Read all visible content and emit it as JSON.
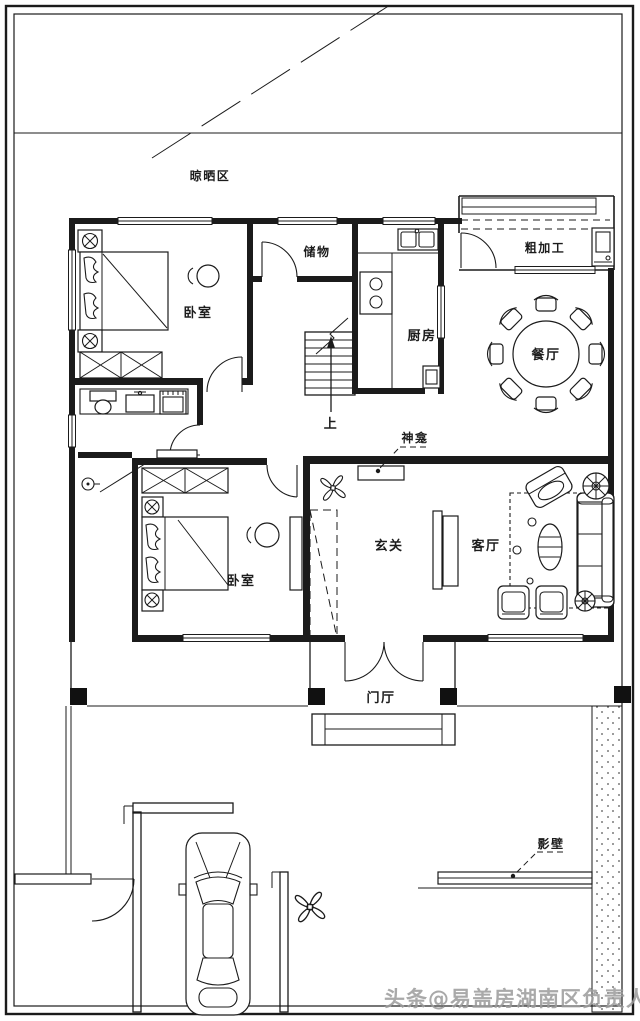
{
  "canvas": {
    "width": 640,
    "height": 1021,
    "background": "#ffffff",
    "ink": "#1b1b1b"
  },
  "labels": {
    "drying_area": "晾晒区",
    "bedroom_upper": "卧室",
    "storage": "储物",
    "kitchen": "厨房",
    "rough_processing": "粗加工",
    "dining": "餐厅",
    "shrine": "神龛",
    "entry_foyer": "玄关",
    "living": "客厅",
    "bedroom_lower": "卧室",
    "door_hall": "门厅",
    "screen_wall": "影壁",
    "stairs_up": "上"
  },
  "watermark": {
    "text": "头条@易盖房湖南区负责人",
    "color": "#9b9b9b"
  }
}
